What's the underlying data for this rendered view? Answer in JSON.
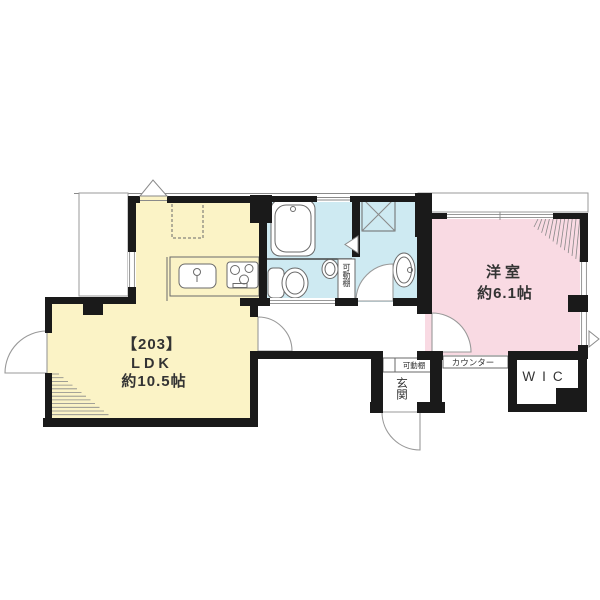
{
  "floorplan": {
    "unit_label": "【203】",
    "ldk": {
      "name": "LDK",
      "size": "約10.5帖"
    },
    "western_room": {
      "name": "洋室",
      "size": "約6.1帖"
    },
    "wic_label": "WIC",
    "entrance_label": "玄関",
    "movable_shelf_label_bath": "可動棚",
    "movable_shelf_label_entrance": "可動棚",
    "counter_label": "カウンター",
    "colors": {
      "ldk_fill": "#FBF3C6",
      "western_fill": "#F9DAE3",
      "wet_area_fill": "#CEEAF2",
      "wall": "#1a1a1a"
    }
  }
}
